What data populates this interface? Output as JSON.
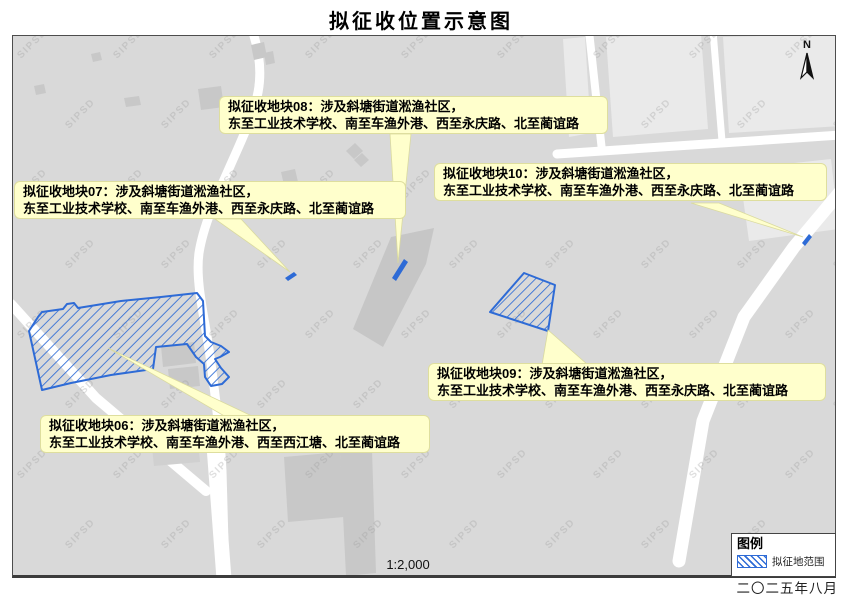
{
  "title": "拟征收位置示意图",
  "map": {
    "scale_label": "1:2,000",
    "north_label": "N",
    "watermark": "SIPSD",
    "date_label": "二〇二五年八月"
  },
  "legend": {
    "title": "图例",
    "items": [
      {
        "label": "拟征地范围",
        "swatch": "blue-diagonal-hatch"
      }
    ]
  },
  "callouts": [
    {
      "id": "block-06",
      "line1": "拟征收地块06：涉及斜塘街道淞渔社区，",
      "line2": "东至工业技术学校、南至车渔外港、西至西江塘、北至蔺谊路"
    },
    {
      "id": "block-07",
      "line1": "拟征收地块07：涉及斜塘街道淞渔社区，",
      "line2": "东至工业技术学校、南至车渔外港、西至永庆路、北至蔺谊路"
    },
    {
      "id": "block-08",
      "line1": "拟征收地块08：涉及斜塘街道淞渔社区，",
      "line2": "东至工业技术学校、南至车渔外港、西至永庆路、北至蔺谊路"
    },
    {
      "id": "block-09",
      "line1": "拟征收地块09：涉及斜塘街道淞渔社区，",
      "line2": "东至工业技术学校、南至车渔外港、西至永庆路、北至蔺谊路"
    },
    {
      "id": "block-10",
      "line1": "拟征收地块10：涉及斜塘街道淞渔社区，",
      "line2": "东至工业技术学校、南至车渔外港、西至永庆路、北至蔺谊路"
    }
  ],
  "colors": {
    "hatch_blue": "#2E6BD6",
    "callout_bg": "#FFFFCC",
    "map_bg": "#D9D9D9",
    "road_white": "#FFFFFF",
    "building_gray": "#C8C8C8",
    "parcel_light": "#EAEAEA"
  }
}
